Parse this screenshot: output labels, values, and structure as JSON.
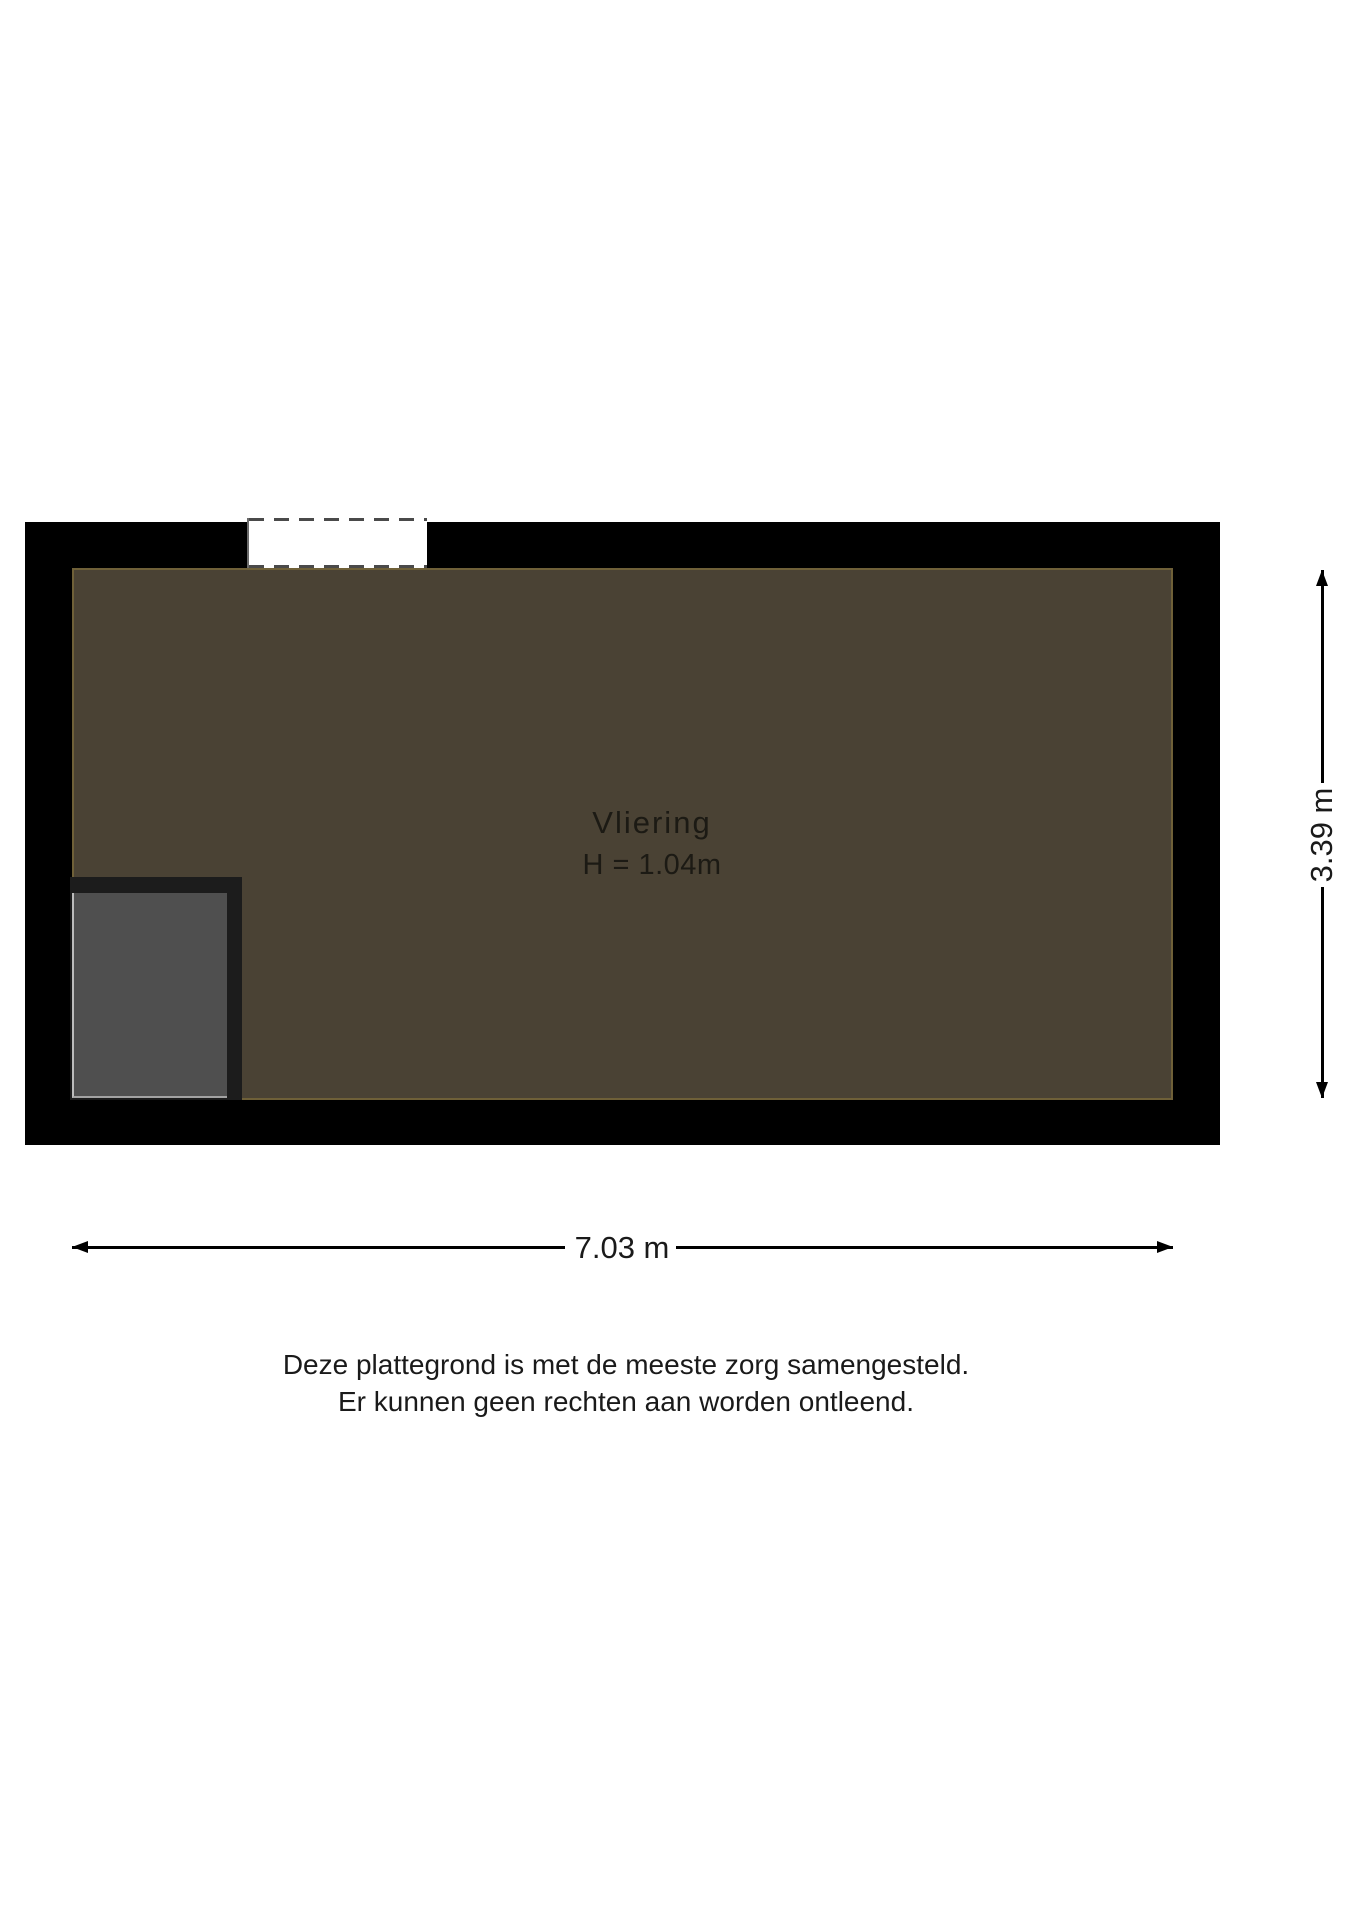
{
  "floorplan": {
    "room": {
      "name": "Vliering",
      "height_label": "H = 1.04m"
    },
    "dimensions": {
      "width": "7.03 m",
      "height": "3.39 m"
    },
    "disclaimer": [
      "Deze plattegrond is met de meeste zorg samengesteld.",
      "Er kunnen geen rechten aan worden ontleend."
    ],
    "colors": {
      "wall": "#000000",
      "room_fill": "#4a4234",
      "room_outline": "#6f6038",
      "window_fill": "#ffffff",
      "dash": "#4a4a4a",
      "stair_frame": "#1c1c1c",
      "stair_fill": "#4f4f4f",
      "dimension": "#000000",
      "text": "#1a1a1a"
    }
  }
}
